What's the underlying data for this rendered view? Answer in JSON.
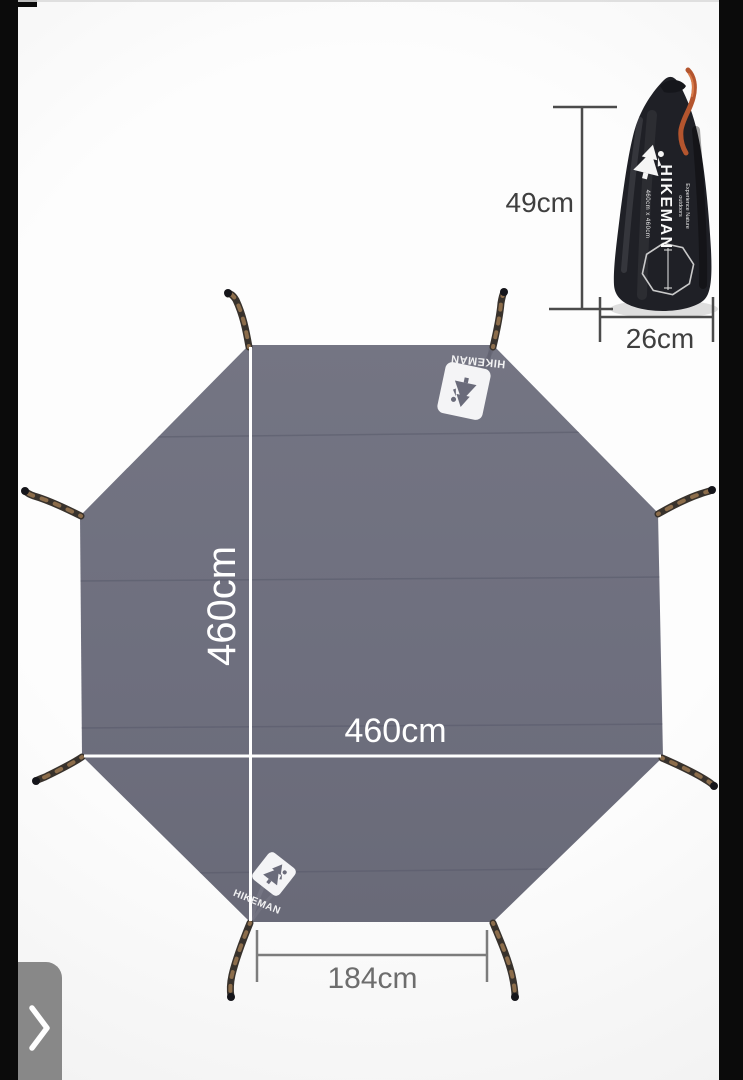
{
  "viewer": {
    "next_button_icon": "chevron-right",
    "letterbox_color": "#0b0b0b"
  },
  "diagram": {
    "tarp": {
      "brand_label_top": "HIKEMAN",
      "brand_label_bottom": "HIKEMAN",
      "vertical_dimension": "460cm",
      "horizontal_dimension": "460cm",
      "bottom_edge_dimension": "184cm",
      "fabric_color": "#6e6f7e",
      "dimension_line_color": "#ffffff"
    },
    "stuff_sack": {
      "brand_label": "HIKEMAN",
      "tagline": "Experience Nature outdoors",
      "size_label": "460cm x 460cm",
      "height_dimension": "49cm",
      "width_dimension": "26cm",
      "bag_color": "#1f2026",
      "drawstring_color": "#b4552e",
      "dimension_line_color": "#4b4b4b"
    }
  }
}
